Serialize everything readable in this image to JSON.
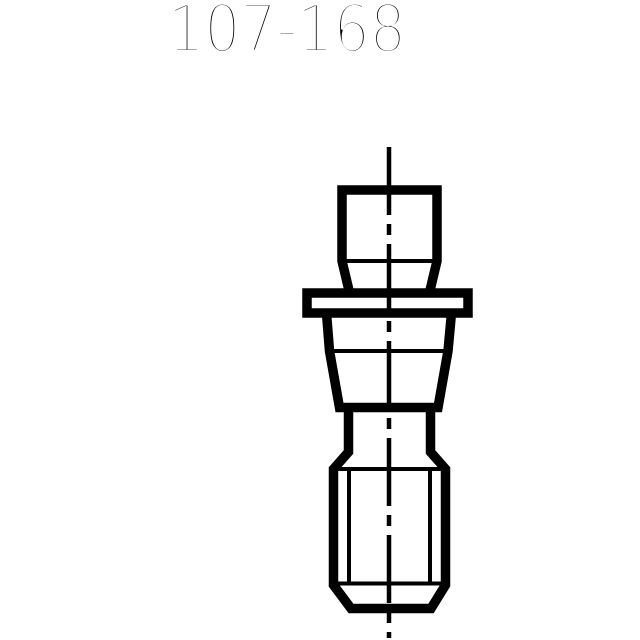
{
  "title": {
    "text": "107-168"
  },
  "drawing": {
    "type": "technical-line-drawing",
    "subject": "retention-knob-pull-stud-front-view",
    "line_color": "#000000",
    "background_color": "#ffffff",
    "parts": [
      "knob-head",
      "shoulder-line",
      "flange",
      "tapered-body",
      "taper-mid-line",
      "neck",
      "threaded-section",
      "thread-chamfer-lines",
      "thread-root-lines",
      "centerline"
    ]
  }
}
